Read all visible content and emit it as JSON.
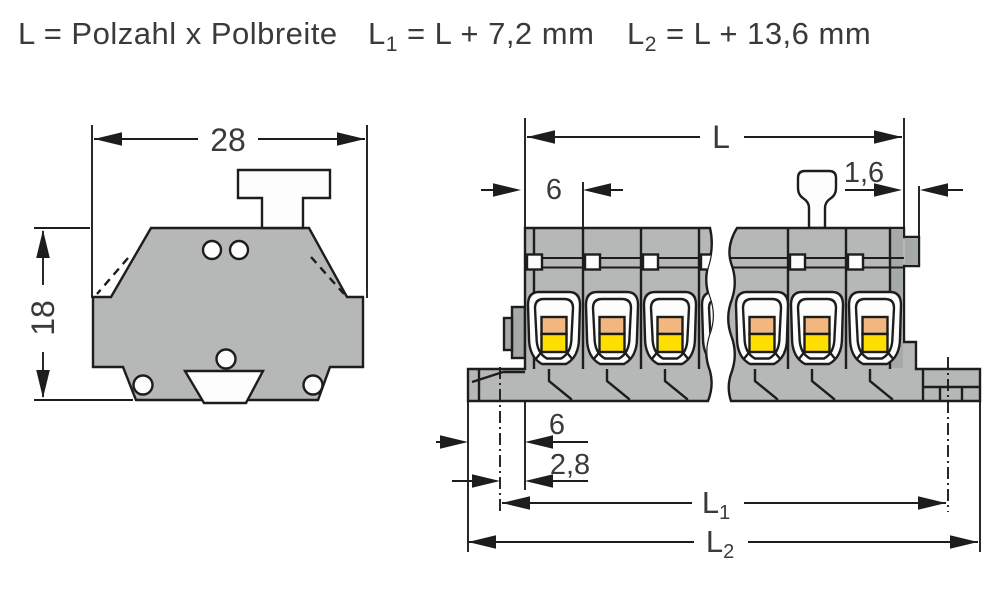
{
  "formula_bar": {
    "pitch_formula": "L = Polzahl x Polbreite",
    "l1_base": "L",
    "l1_sub": "1",
    "l1_formula": "= L + 7,2 mm",
    "l2_base": "L",
    "l2_sub": "2",
    "l2_formula": "= L + 13,6 mm"
  },
  "side_view": {
    "width_mm": "28",
    "height_mm": "18"
  },
  "front_view": {
    "total_length": "L",
    "pole_width_mm": "6",
    "end_plate_mm": "1,6",
    "foot_offset_mm": "6",
    "hole_offset_mm": "2,8",
    "l1_base": "L",
    "l1_sub": "1",
    "l2_base": "L",
    "l2_sub": "2"
  },
  "colors": {
    "background": "#ffffff",
    "line": "#1d1d1b",
    "text": "#3a3a3a",
    "body_gray": "#b5b8b6",
    "body_gray_dark": "#a5a9a8",
    "opening_white": "#fdfdfd",
    "lever_orange": "#f2b77f",
    "lever_yellow": "#ffdf00"
  }
}
